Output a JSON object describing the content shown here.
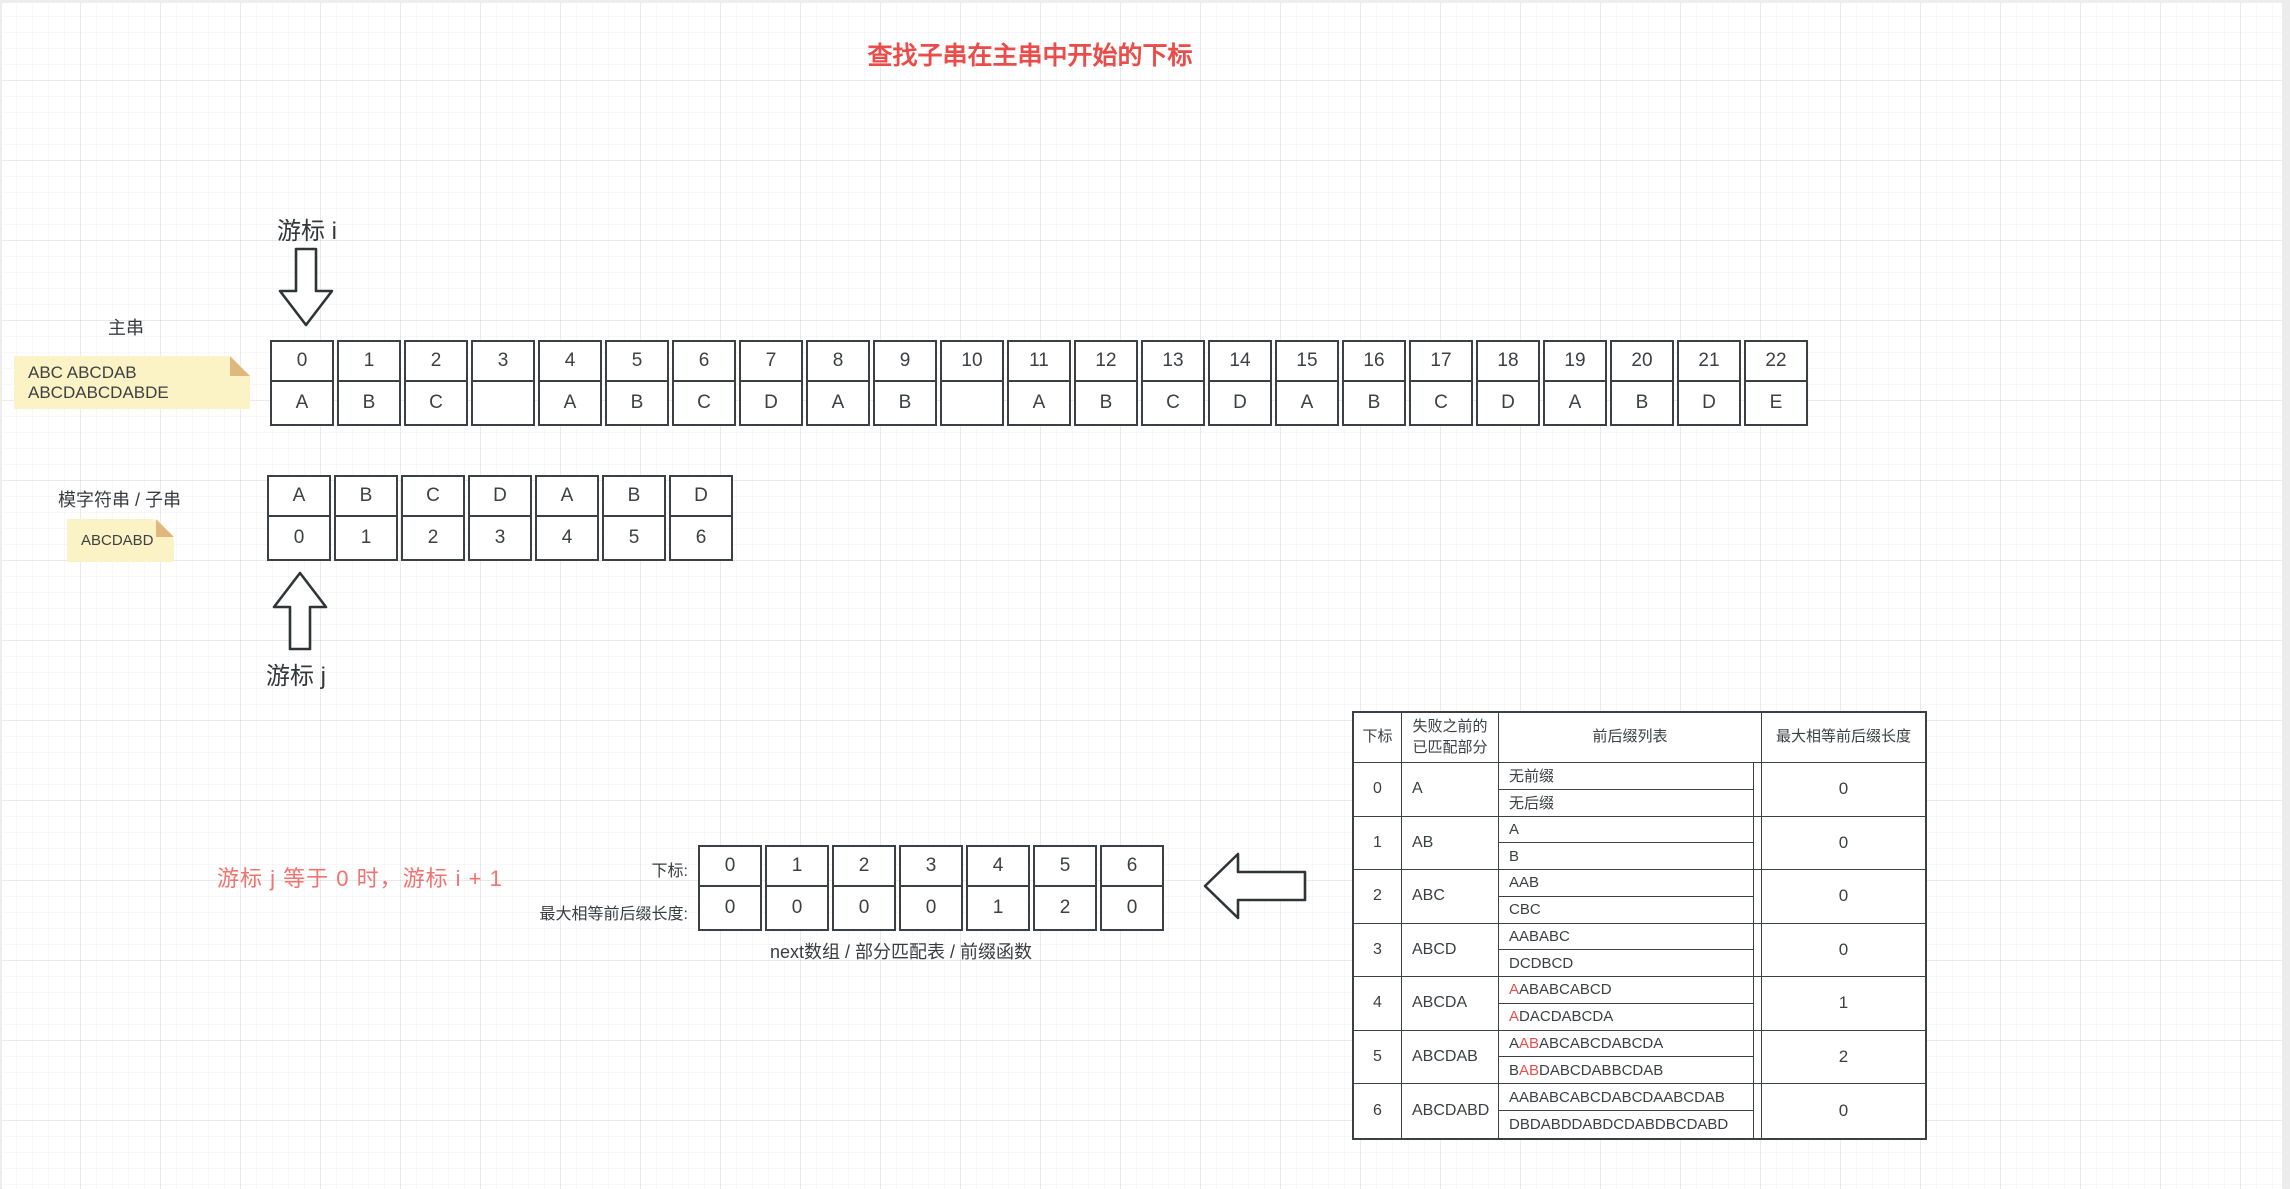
{
  "title": "查找子串在主串中开始的下标",
  "labels": {
    "cursor_i": "游标 i",
    "cursor_j": "游标 j",
    "main_string": "主串",
    "pattern_string": "模字符串 / 子串",
    "red_note": "游标 j 等于 0 时，游标 i + 1",
    "next_index_label": "下标:",
    "next_value_label": "最大相等前后缀长度:",
    "next_caption": "next数组 / 部分匹配表 / 前缀函数"
  },
  "sticky_notes": {
    "main": "ABC ABCDAB ABCDABCDABDE",
    "pattern": "ABCDABD"
  },
  "main_table": {
    "indices": [
      "0",
      "1",
      "2",
      "3",
      "4",
      "5",
      "6",
      "7",
      "8",
      "9",
      "10",
      "11",
      "12",
      "13",
      "14",
      "15",
      "16",
      "17",
      "18",
      "19",
      "20",
      "21",
      "22"
    ],
    "chars": [
      "A",
      "B",
      "C",
      "",
      "A",
      "B",
      "C",
      "D",
      "A",
      "B",
      "",
      "A",
      "B",
      "C",
      "D",
      "A",
      "B",
      "C",
      "D",
      "A",
      "B",
      "D",
      "E"
    ]
  },
  "pattern_table": {
    "chars": [
      "A",
      "B",
      "C",
      "D",
      "A",
      "B",
      "D"
    ],
    "indices": [
      "0",
      "1",
      "2",
      "3",
      "4",
      "5",
      "6"
    ]
  },
  "next_table": {
    "indices": [
      "0",
      "1",
      "2",
      "3",
      "4",
      "5",
      "6"
    ],
    "values": [
      "0",
      "0",
      "0",
      "0",
      "1",
      "2",
      "0"
    ]
  },
  "prefix_table": {
    "headers": [
      "下标",
      "失败之前的已匹配部分",
      "前后缀列表",
      "最大相等前后缀长度"
    ],
    "rows": [
      {
        "index": "0",
        "matched": "A",
        "prefixes": [
          {
            "t": "无前缀",
            "red": false
          }
        ],
        "suffixes": [
          {
            "t": "无后缀",
            "red": false
          }
        ],
        "value": "0"
      },
      {
        "index": "1",
        "matched": "AB",
        "prefixes": [
          {
            "t": "A",
            "red": false
          }
        ],
        "suffixes": [
          {
            "t": "B",
            "red": false
          }
        ],
        "value": "0"
      },
      {
        "index": "2",
        "matched": "ABC",
        "prefixes": [
          {
            "t": "A",
            "red": false
          },
          {
            "t": "AB",
            "red": false
          }
        ],
        "suffixes": [
          {
            "t": "C",
            "red": false
          },
          {
            "t": "BC",
            "red": false
          }
        ],
        "value": "0"
      },
      {
        "index": "3",
        "matched": "ABCD",
        "prefixes": [
          {
            "t": "A",
            "red": false
          },
          {
            "t": "AB",
            "red": false
          },
          {
            "t": "ABC",
            "red": false
          }
        ],
        "suffixes": [
          {
            "t": "D",
            "red": false
          },
          {
            "t": "CD",
            "red": false
          },
          {
            "t": "BCD",
            "red": false
          }
        ],
        "value": "0"
      },
      {
        "index": "4",
        "matched": "ABCDA",
        "prefixes": [
          {
            "t": "A",
            "red": true
          },
          {
            "t": "AB",
            "red": false
          },
          {
            "t": "ABC",
            "red": false
          },
          {
            "t": "ABCD",
            "red": false
          }
        ],
        "suffixes": [
          {
            "t": "A",
            "red": true
          },
          {
            "t": "DA",
            "red": false
          },
          {
            "t": "CDA",
            "red": false
          },
          {
            "t": "BCDA",
            "red": false
          }
        ],
        "value": "1"
      },
      {
        "index": "5",
        "matched": "ABCDAB",
        "prefixes": [
          {
            "t": "A",
            "red": false
          },
          {
            "t": "AB",
            "red": true
          },
          {
            "t": "ABC",
            "red": false
          },
          {
            "t": "ABCD",
            "red": false
          },
          {
            "t": "ABCDA",
            "red": false
          }
        ],
        "suffixes": [
          {
            "t": "B",
            "red": false
          },
          {
            "t": "AB",
            "red": true
          },
          {
            "t": "DAB",
            "red": false
          },
          {
            "t": "CDAB",
            "red": false
          },
          {
            "t": "BCDAB",
            "red": false
          }
        ],
        "value": "2"
      },
      {
        "index": "6",
        "matched": "ABCDABD",
        "prefixes": [
          {
            "t": "A",
            "red": false
          },
          {
            "t": "AB",
            "red": false
          },
          {
            "t": "ABC",
            "red": false
          },
          {
            "t": "ABCD",
            "red": false
          },
          {
            "t": "ABCDA",
            "red": false
          },
          {
            "t": "ABCDAB",
            "red": false
          }
        ],
        "suffixes": [
          {
            "t": "D",
            "red": false
          },
          {
            "t": "BD",
            "red": false
          },
          {
            "t": "ABD",
            "red": false
          },
          {
            "t": "DABD",
            "red": false
          },
          {
            "t": "CDABD",
            "red": false
          },
          {
            "t": "BCDABD",
            "red": false
          }
        ],
        "value": "0"
      }
    ]
  },
  "colors": {
    "accent_red": "#e94c49",
    "soft_red": "#f2726e",
    "token_red": "#e2504d",
    "sticky_bg": "#fbf3c5",
    "sticky_fold": "#e0b87e",
    "stroke": "#3b4045"
  }
}
